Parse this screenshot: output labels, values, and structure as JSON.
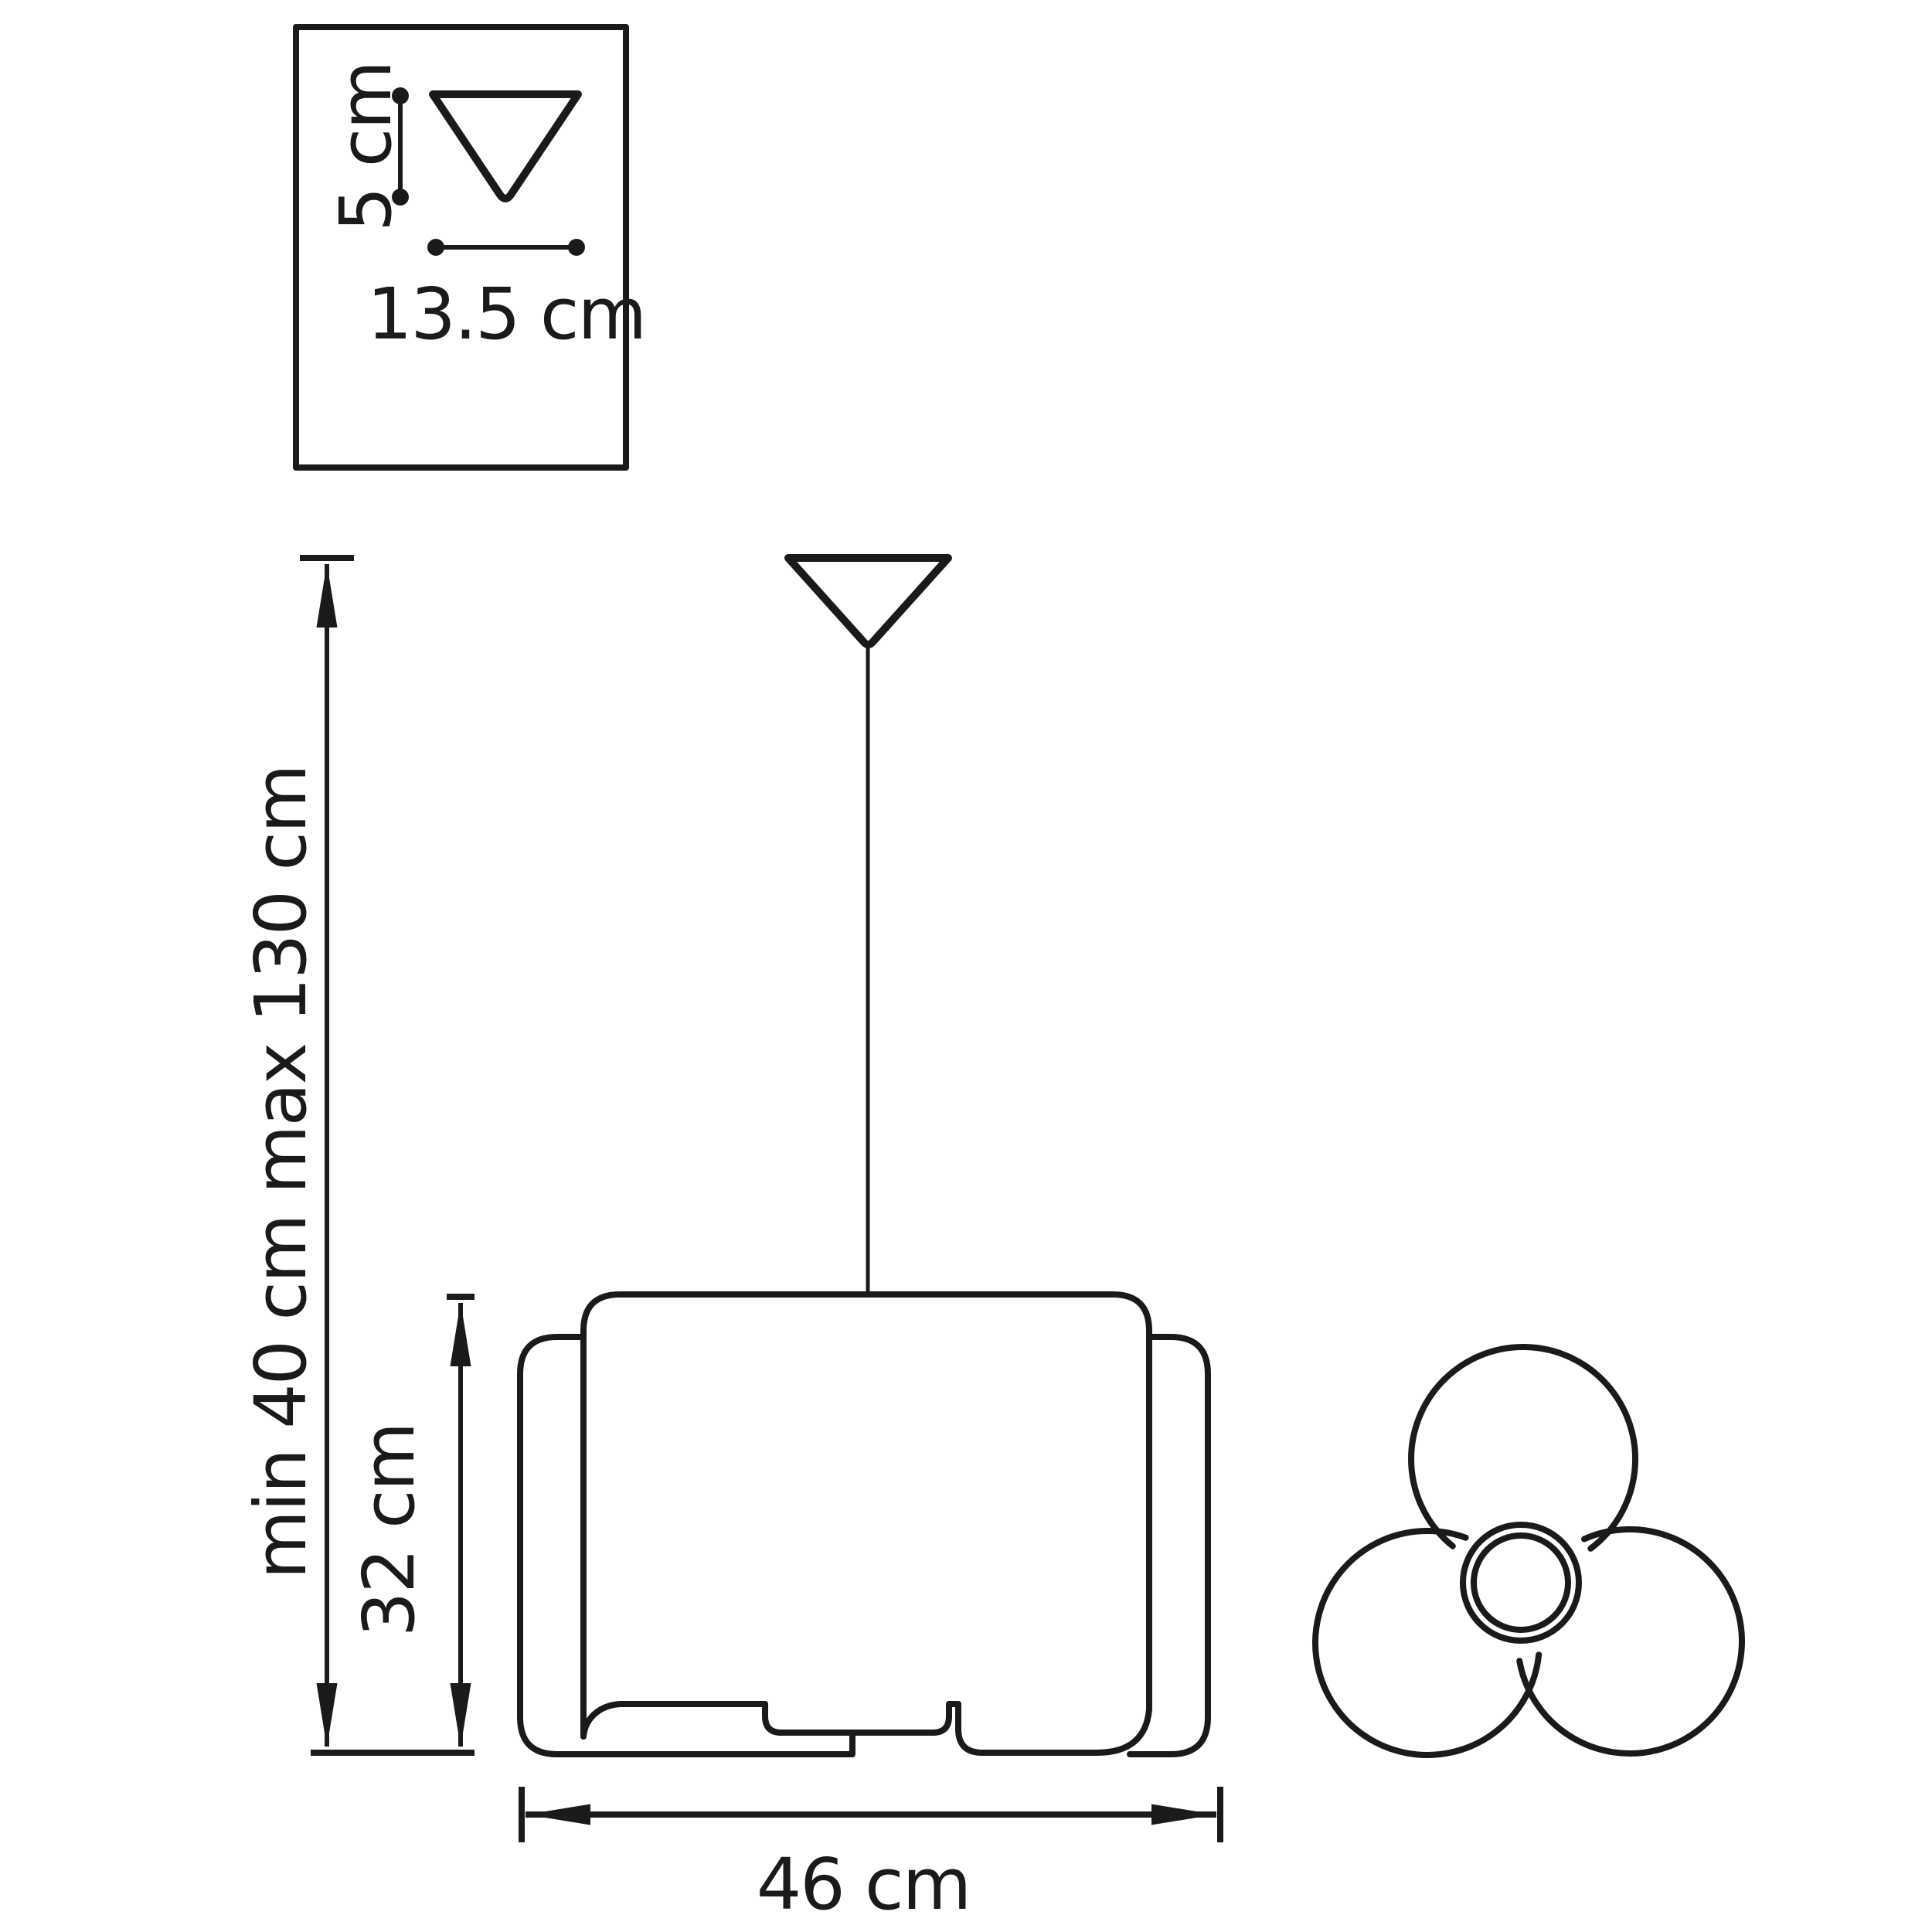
{
  "diagram": {
    "background": "#ffffff",
    "stroke_color": "#1a1a1a",
    "inset": {
      "canopy_height_label": "5 cm",
      "canopy_width_label": "13.5 cm"
    },
    "side_view": {
      "suspension_label": "min 40 cm max 130 cm",
      "shade_height_label": "32 cm",
      "shade_width_label": "46 cm"
    }
  }
}
